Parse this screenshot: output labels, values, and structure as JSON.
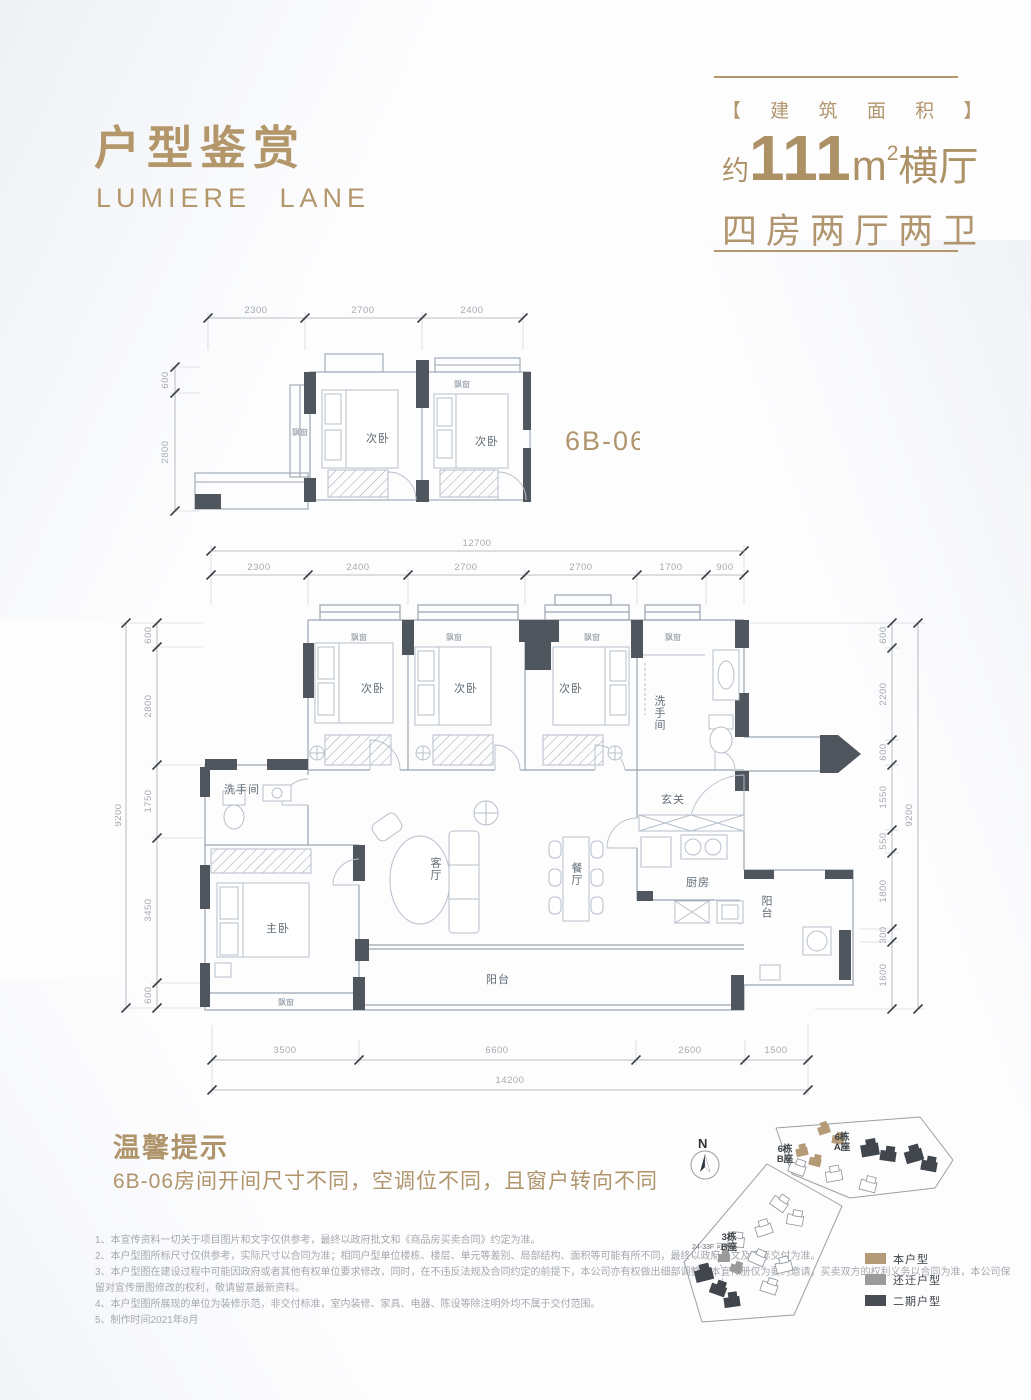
{
  "header": {
    "title": "户型鉴赏",
    "subtitle": "LUMIERE LANE",
    "area_tag": "【 建 筑 面 积 】",
    "area_about": "约",
    "area_number": "111",
    "area_unit": "m",
    "area_power": "2",
    "area_type": "横厅",
    "rooms_desc": "四房两厅两卫"
  },
  "unit": {
    "code": "6B-06"
  },
  "labels": {
    "bay_window": "飘窗",
    "bedroom": "次卧",
    "master_bedroom": "主卧",
    "living_room": "客厅",
    "dining_room": "餐厅",
    "kitchen": "厨房",
    "balcony": "阳台",
    "bathroom": "洗手间",
    "foyer": "玄关"
  },
  "upper_plan": {
    "dims_top": [
      "2300",
      "2700",
      "2400"
    ],
    "dims_left": [
      "600",
      "2800"
    ]
  },
  "main_plan": {
    "dim_width_total": "12700",
    "dims_top": [
      "2300",
      "2400",
      "2700",
      "2700",
      "1700",
      "900"
    ],
    "dims_left": [
      "600",
      "2800",
      "1750",
      "3450",
      "600"
    ],
    "dim_left_total": "9200",
    "dims_right": [
      "600",
      "2200",
      "600",
      "1550",
      "550",
      "1800",
      "300",
      "1600"
    ],
    "dim_right_total": "9200",
    "dims_bottom": [
      "3500",
      "6600",
      "2600",
      "1500"
    ],
    "dim_bottom_total": "14200"
  },
  "tips": {
    "title": "温馨提示",
    "content": "6B-06房间开间尺寸不同，空调位不同，且窗户转向不同"
  },
  "notes": [
    "1、本宣传资料一切关于项目图片和文字仅供参考，最终以政府批文和《商品房买卖合同》约定为准。",
    "2、本户型图所标尺寸仅供参考，实际尺寸以合同为准；相同户型单位楼栋、楼层、单元等差别、局部结构、面积等可能有所不同，最终以政府批文及实际交付为准。",
    "3、本户型图在建设过程中可能因政府或者其他有权单位要求修改，同时，在不违反法规及合同约定的前提下，本公司亦有权做出细部调整，本宣传册仅为要约邀请，买卖双方的权利义务以合同为准，本公司保留对宣传册图修改的权利，敬请留意最新资料。",
    "4、本户型图所展现的单位为装修示范，非交付标准，室内装修、家具、电器、陈设等除注明外均不属于交付范围。",
    "5、制作时间2021年8月"
  ],
  "site_map": {
    "north": "N",
    "sale_note": "24-33F 可售",
    "buildings": [
      {
        "line1": "6栋",
        "line2": "B座"
      },
      {
        "line1": "6栋",
        "line2": "A座"
      },
      {
        "line1": "3栋",
        "line2": "B座"
      }
    ],
    "legend": [
      {
        "label": "本户型",
        "color": "#b59a77"
      },
      {
        "label": "还迁户型",
        "color": "#9b9b9b"
      },
      {
        "label": "二期户型",
        "color": "#474d53"
      }
    ]
  }
}
